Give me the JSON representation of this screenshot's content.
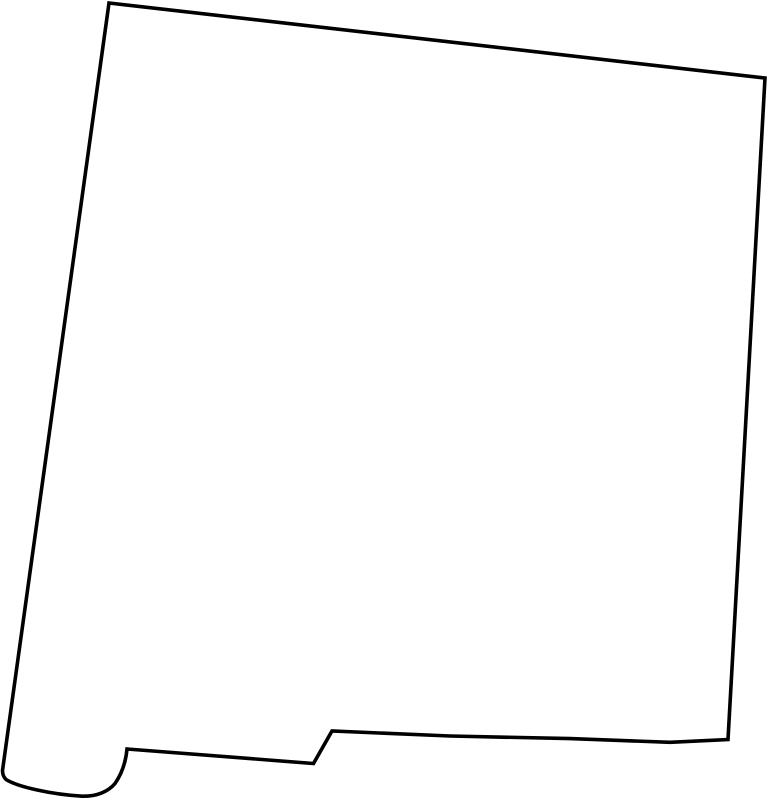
{
  "page": {
    "background_color": "#ffffff"
  },
  "map": {
    "name": "new-mexico-outline",
    "viewbox": "0 0 769 800",
    "outline_color": "#000000",
    "fill_color": "#ffffff",
    "stroke_width": "3.6",
    "outline_path": "M 109,3 L 765,78 L 728,739.5 L 670,742.3 L 570,738.6 L 450,736 L 332,731 L 313.5,763.5 L 127,749 C 126,760 123,772 115,783.5 C 108,792 96,796.5 82,796.2 C 52,794.5 18,787 6,779.5 Q 2.5,776 2.5,770.5 Z"
  }
}
